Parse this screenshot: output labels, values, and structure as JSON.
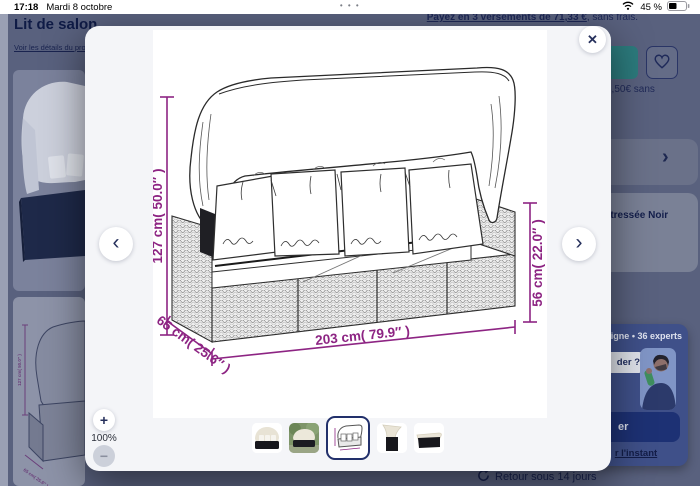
{
  "status_bar": {
    "time": "17:18",
    "date": "Mardi 8 octobre",
    "battery_percent": "45 %",
    "handle": "• • •"
  },
  "page": {
    "title": "Lit de salon",
    "details_link": "Voir les détails du pro",
    "installments_link": "Payez en 3 versements de 71,33 €",
    "installments_suffix": ", sans frais.",
    "price_fragment": "3,50€ sans",
    "carousel_next": "›",
    "variant_fragment": "e tressée Noir",
    "returns_text": "Retour sous 14 jours",
    "support_widget": {
      "status_fragment": "n ligne • 36 experts",
      "bubble_fragment": "der ?",
      "cta_fragment": "er",
      "dismiss_fragment": "r l'instant"
    }
  },
  "modal": {
    "close": "✕",
    "prev": "‹",
    "next": "›",
    "zoom": {
      "in": "+",
      "out": "−",
      "level": "100%"
    },
    "drawing": {
      "height_label": "127 cm( 50.0″ )",
      "length_label": "203 cm( 79.9″ )",
      "depth_label": "65 cm( 25.6″ )",
      "backrest_label": "56 cm( 22.0″ )"
    },
    "thumbnails": [
      {
        "name": "daybed-front-view",
        "selected": false
      },
      {
        "name": "daybed-in-garden",
        "selected": false
      },
      {
        "name": "dimensions-line-drawing",
        "selected": true
      },
      {
        "name": "canopy-corner-detail",
        "selected": false
      },
      {
        "name": "daybed-canopy-folded",
        "selected": false
      }
    ]
  },
  "colors": {
    "dimension_purple": "#8d2483",
    "accent_teal": "#2c7b7d",
    "navy": "#1d3174",
    "widget_blue": "#3f5089"
  }
}
